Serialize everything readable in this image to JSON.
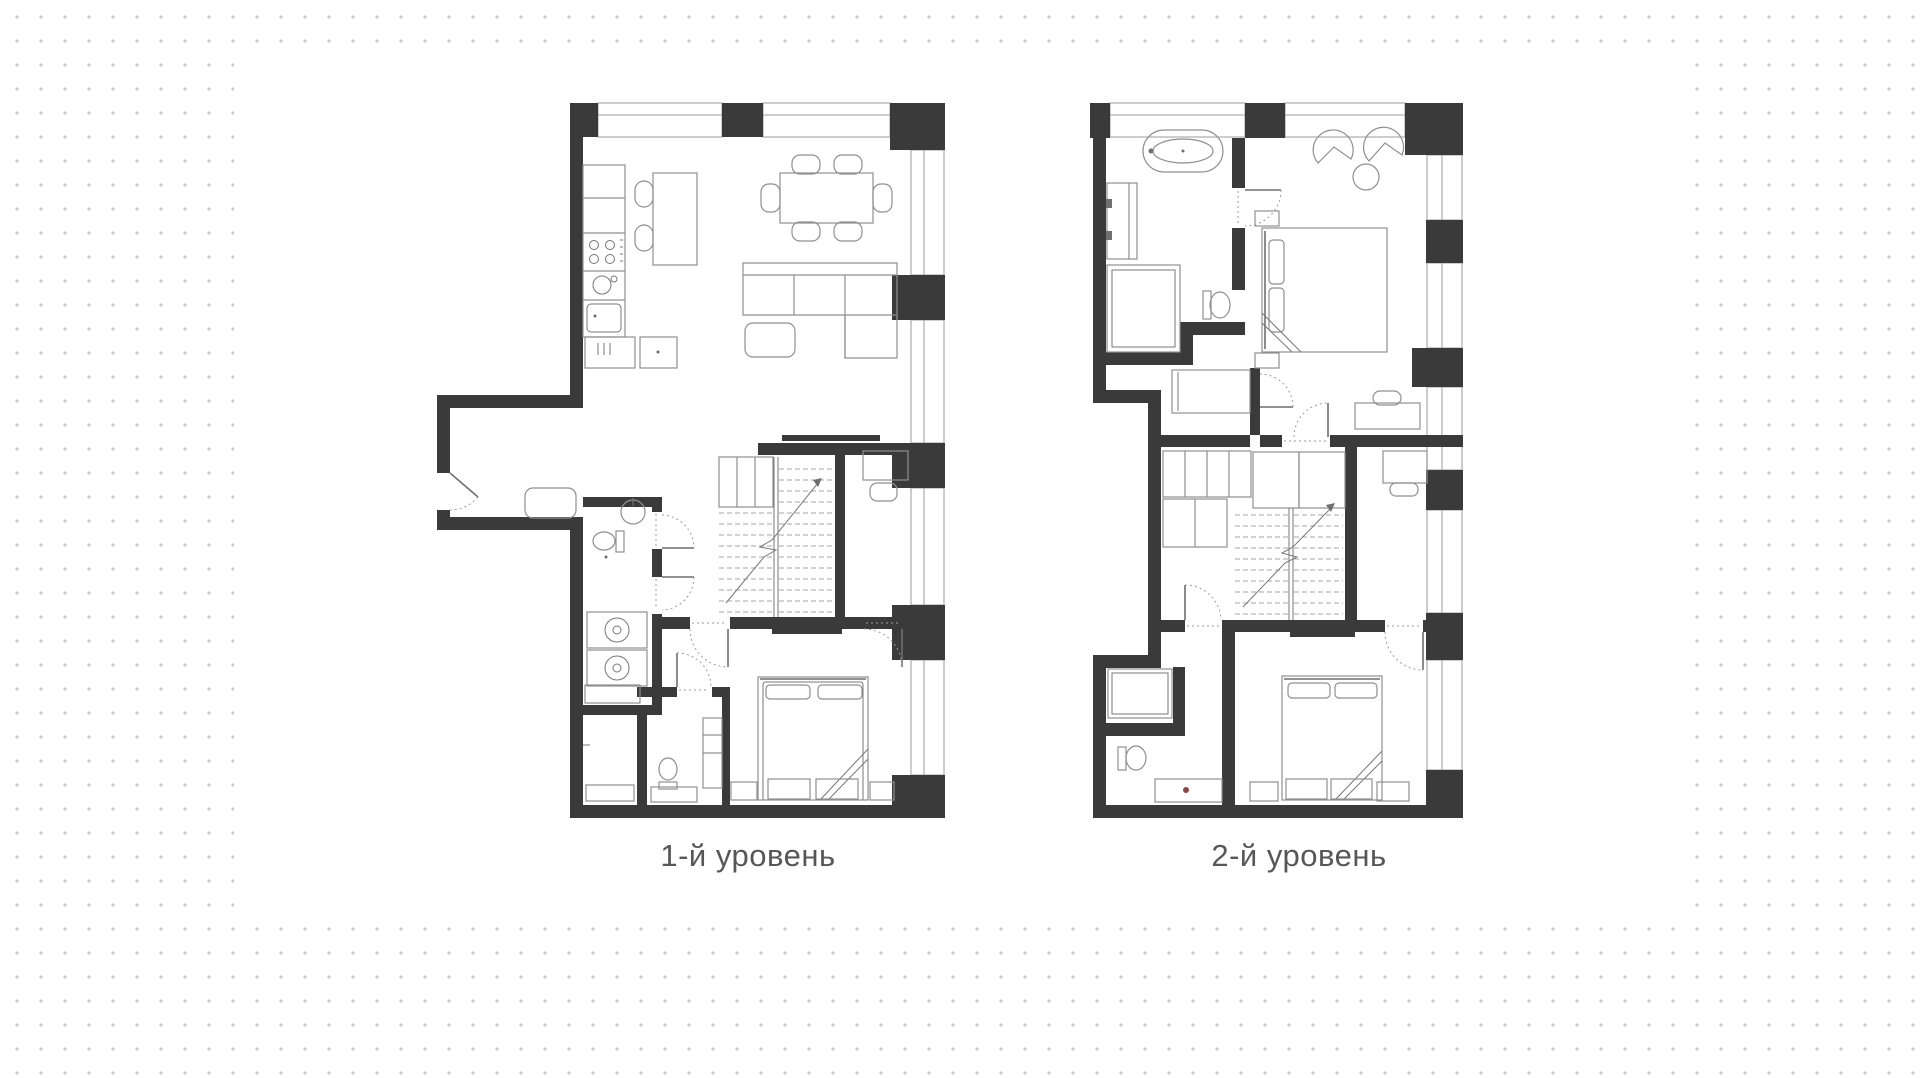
{
  "canvas": {
    "width": 1920,
    "height": 1078
  },
  "background": {
    "dot_color": "#c9c9c9",
    "dot_spacing_px": 24,
    "panel_color": "#ffffff"
  },
  "labels": {
    "level1": "1-й уровень",
    "level2": "2-й уровень"
  },
  "colors": {
    "wall": "#3a3a3a",
    "furniture_line": "#8f8f8f",
    "dashed_line": "#a6a6a6",
    "label_text": "#57575a",
    "faucet_accent": "#8a4742"
  }
}
